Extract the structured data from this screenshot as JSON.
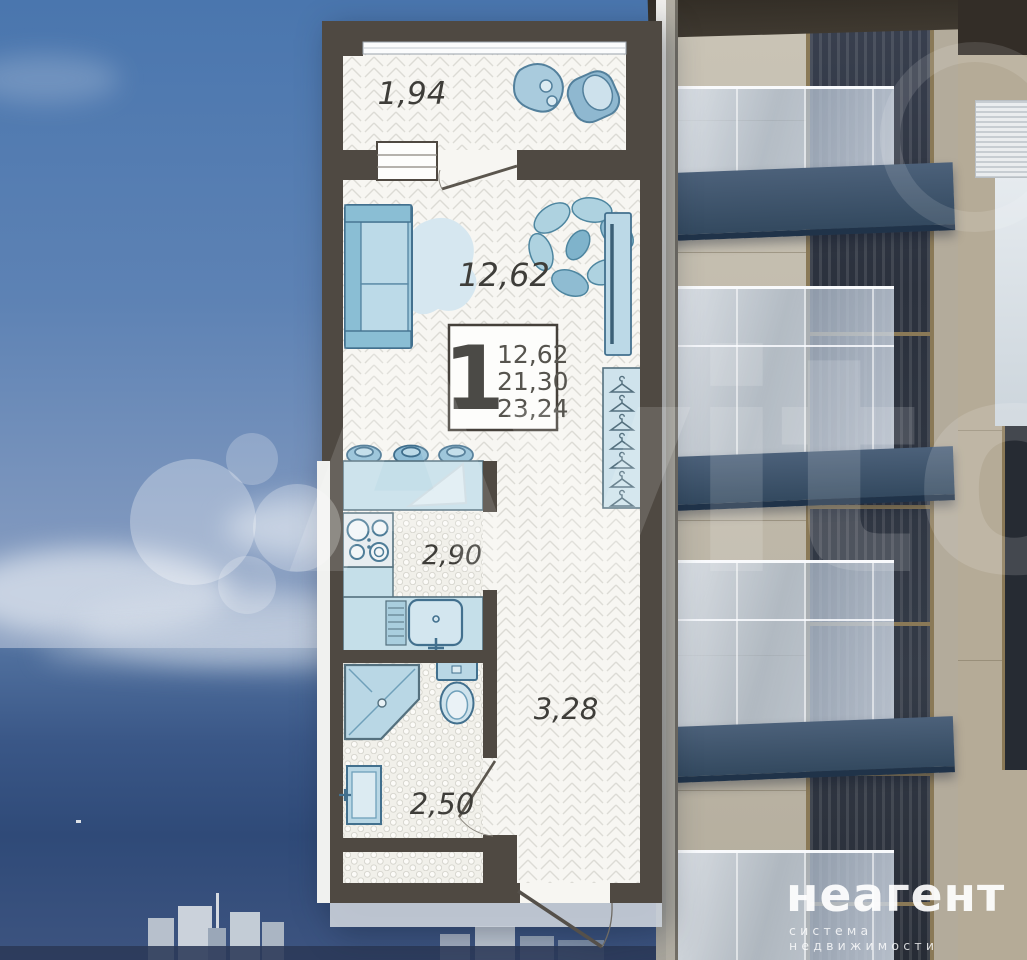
{
  "floorplan": {
    "legend": {
      "rooms_count": "1",
      "area_living": "12,62",
      "area_total": "21,30",
      "area_overall": "23,24"
    },
    "rooms": {
      "balcony": "1,94",
      "living": "12,62",
      "kitchen": "2,90",
      "bathroom": "2,50",
      "hallway": "3,28"
    }
  },
  "watermark": {
    "text": "Avito"
  },
  "branding": {
    "logo": "неагент",
    "tagline": "система недвижимости"
  },
  "colors": {
    "wall": "#4f4942",
    "furniture_fill": "#bcd9e7",
    "furniture_stroke": "#42708e",
    "fascia_blue": "#3c5672",
    "sky": "#4a76ae",
    "sea": "#2f4a78"
  }
}
